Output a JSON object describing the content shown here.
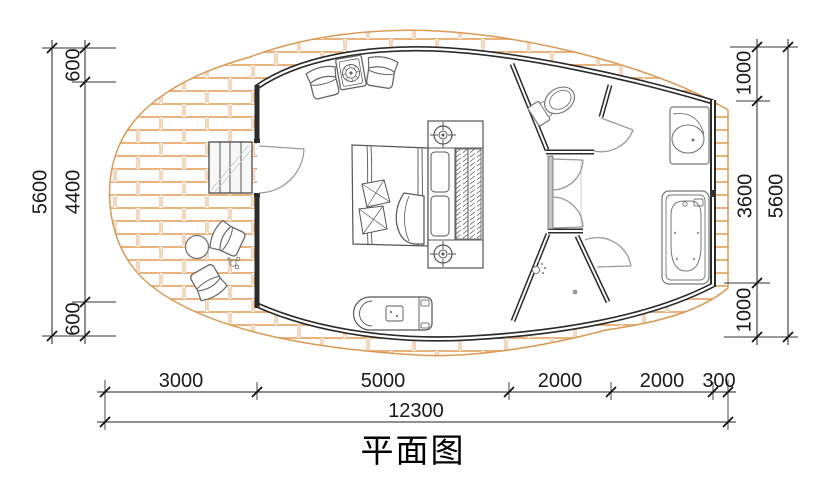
{
  "title": "平面图",
  "dimensions": {
    "left": {
      "segments": [
        "600",
        "4400",
        "600"
      ],
      "total": "5600"
    },
    "right": {
      "segments": [
        "1000",
        "3600",
        "1000"
      ],
      "total": "5600"
    },
    "bottom": {
      "segments": [
        "3000",
        "5000",
        "2000",
        "2000",
        "300"
      ],
      "total": "12300"
    }
  },
  "colors": {
    "deck_outline": "#d89a55",
    "brick_line": "#eab27c",
    "wall": "#2b2b2b",
    "furniture_line": "#666666",
    "door_line": "#9a9a9a",
    "dimension_text": "#1a1a1a"
  },
  "icons": {
    "toilet": "toilet-plan-symbol",
    "bathtub": "bathtub-plan-symbol",
    "sink": "vanity-basin-symbol",
    "shower": "shower-head-symbol",
    "bed": "double-bed-symbol",
    "stairs": "entry-steps-symbol"
  }
}
